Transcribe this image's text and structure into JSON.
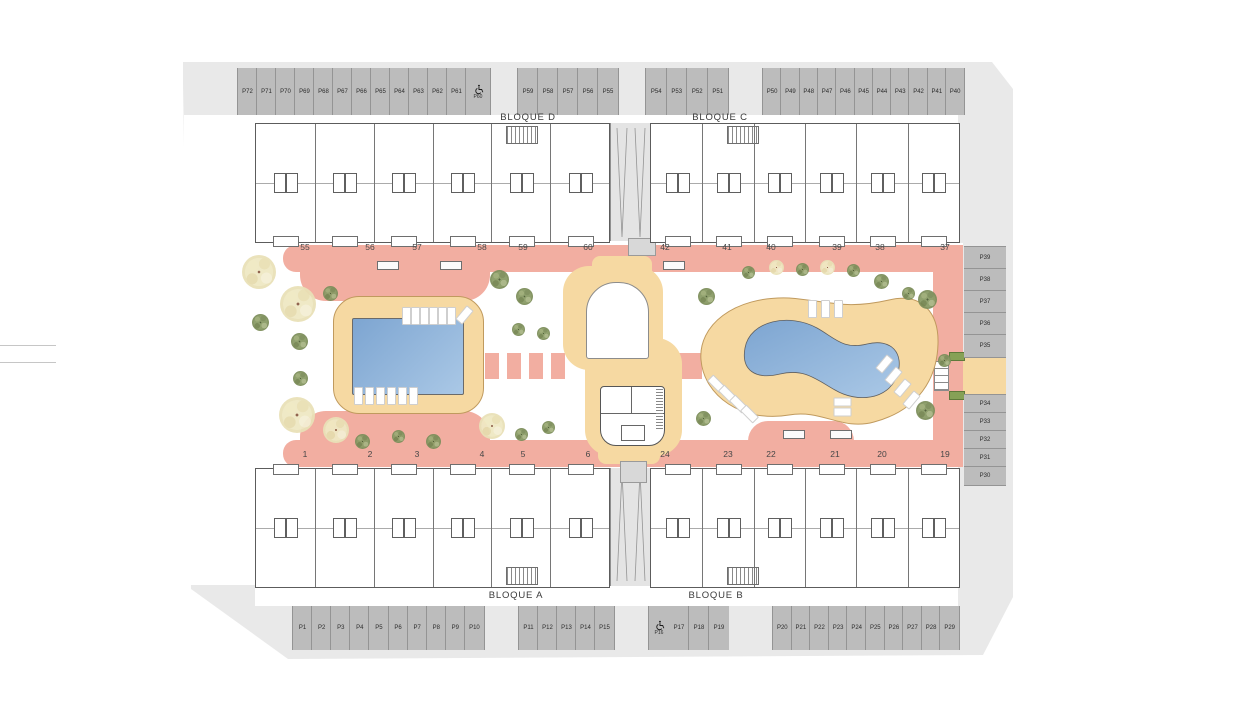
{
  "bloques": {
    "top_left_wing": "BLOQUE D",
    "top_right_wing": "BLOQUE C",
    "bottom_left_wing": "BLOQUE A",
    "bottom_right_wing": "BLOQUE B"
  },
  "parking": {
    "top_left": [
      "P72",
      "P71",
      "P70",
      "P69",
      "P68",
      "P67",
      "P66",
      "P65",
      "P64",
      "P63",
      "P62",
      "P61"
    ],
    "accessible_top": "P60",
    "top_mid": [
      "P59",
      "P58",
      "P57",
      "P56",
      "P55"
    ],
    "top_mid2": [
      "P54",
      "P53",
      "P52",
      "P51"
    ],
    "top_right": [
      "P50",
      "P49",
      "P48",
      "P47",
      "P46",
      "P45",
      "P44",
      "P43",
      "P42",
      "P41",
      "P40"
    ],
    "right_upper": [
      "P39",
      "P38",
      "P37",
      "P36",
      "P35"
    ],
    "right_lower": [
      "P34",
      "P33",
      "P32",
      "P31",
      "P30"
    ],
    "bottom_left": [
      "P1",
      "P2",
      "P3",
      "P4",
      "P5",
      "P6",
      "P7",
      "P8",
      "P9",
      "P10"
    ],
    "bottom_mid": [
      "P11",
      "P12",
      "P13",
      "P14",
      "P15"
    ],
    "accessible_bottom": "P16",
    "bottom_mid2": [
      "P17",
      "P18",
      "P19"
    ],
    "bottom_right": [
      "P20",
      "P21",
      "P22",
      "P23",
      "P24",
      "P25",
      "P26",
      "P27",
      "P28",
      "P29"
    ]
  },
  "unit_numbers": {
    "top": [
      "55",
      "56",
      "57",
      "58",
      "59",
      "60",
      "42",
      "41",
      "40",
      "39",
      "38",
      "37"
    ],
    "bottom": [
      "1",
      "2",
      "3",
      "4",
      "5",
      "6",
      "24",
      "23",
      "22",
      "21",
      "20",
      "19"
    ]
  },
  "icons": {
    "accessible": "wheelchair-icon"
  },
  "colors": {
    "plot": "#e9e9e9",
    "stall": "#bcbcbc",
    "walkway": "#f2aea1",
    "deck": "#f6d9a2",
    "pool_dark": "#7da5d1",
    "pool_light": "#aac8e6",
    "tree_green": "#8a9b66",
    "tree_cream": "#efe8c4"
  }
}
